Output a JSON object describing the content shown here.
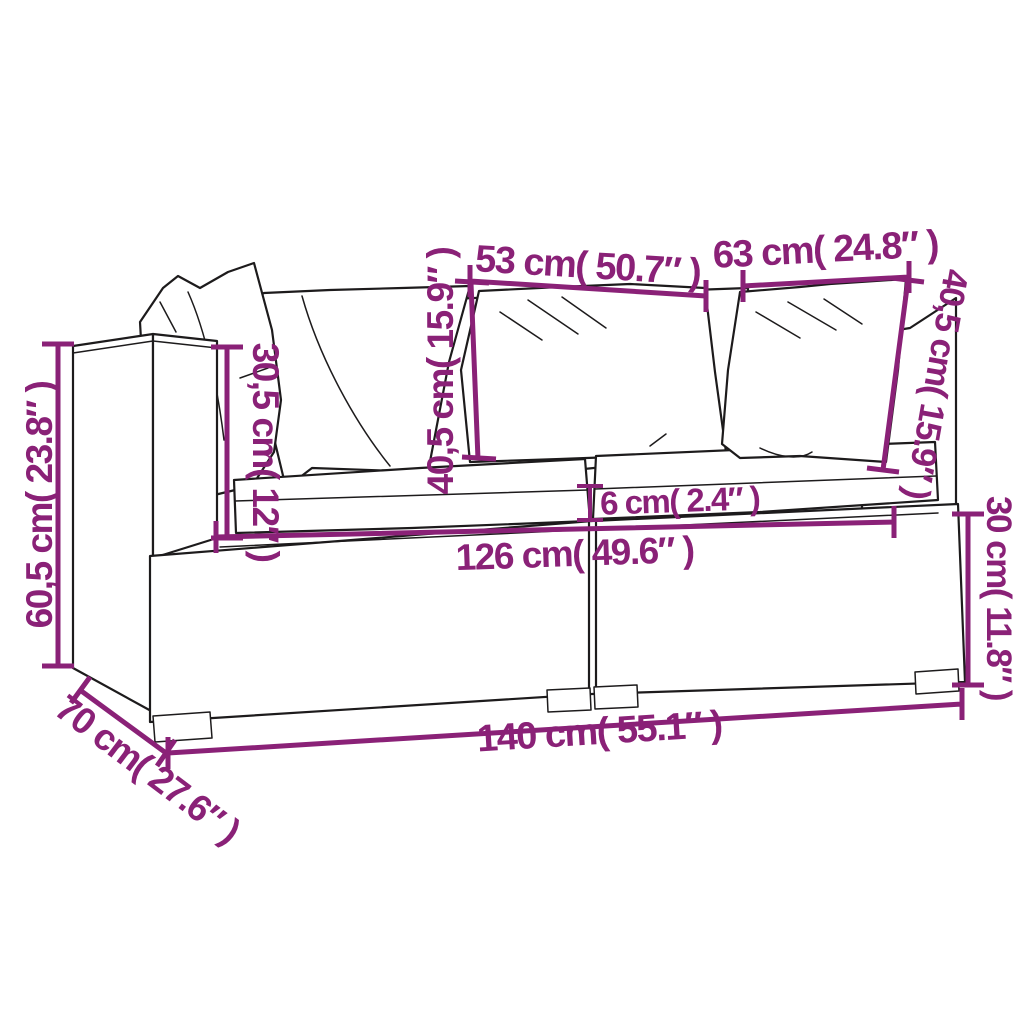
{
  "diagram": {
    "kind": "furniture-dimension-line-drawing",
    "subject": "2-seat poly rattan garden sofa with cushions",
    "colors": {
      "dimension": "#8a2177",
      "line_art": "#1d1b1c",
      "background": "#ffffff",
      "cushion_fill": "#ffffff"
    },
    "dimensions": {
      "backrest_width_left": "53 cm( 50.7″ )",
      "backrest_width_right": "63 cm( 24.8″ )",
      "back_cushion_height_center": "40,5 cm( 15.9″ )",
      "back_cushion_height_right": "40,5 cm( 15.9″ )",
      "armrest_height_above_seat": "30,5 cm( 12″ )",
      "overall_height": "60,5 cm( 23.8″ )",
      "overall_depth": "70 cm( 27.6″ )",
      "overall_width": "140 cm( 55.1″ )",
      "seat_width": "126 cm( 49.6″ )",
      "seat_cushion_thickness": "6 cm( 2.4″ )",
      "seat_height": "30 cm( 11.8″ )"
    }
  }
}
